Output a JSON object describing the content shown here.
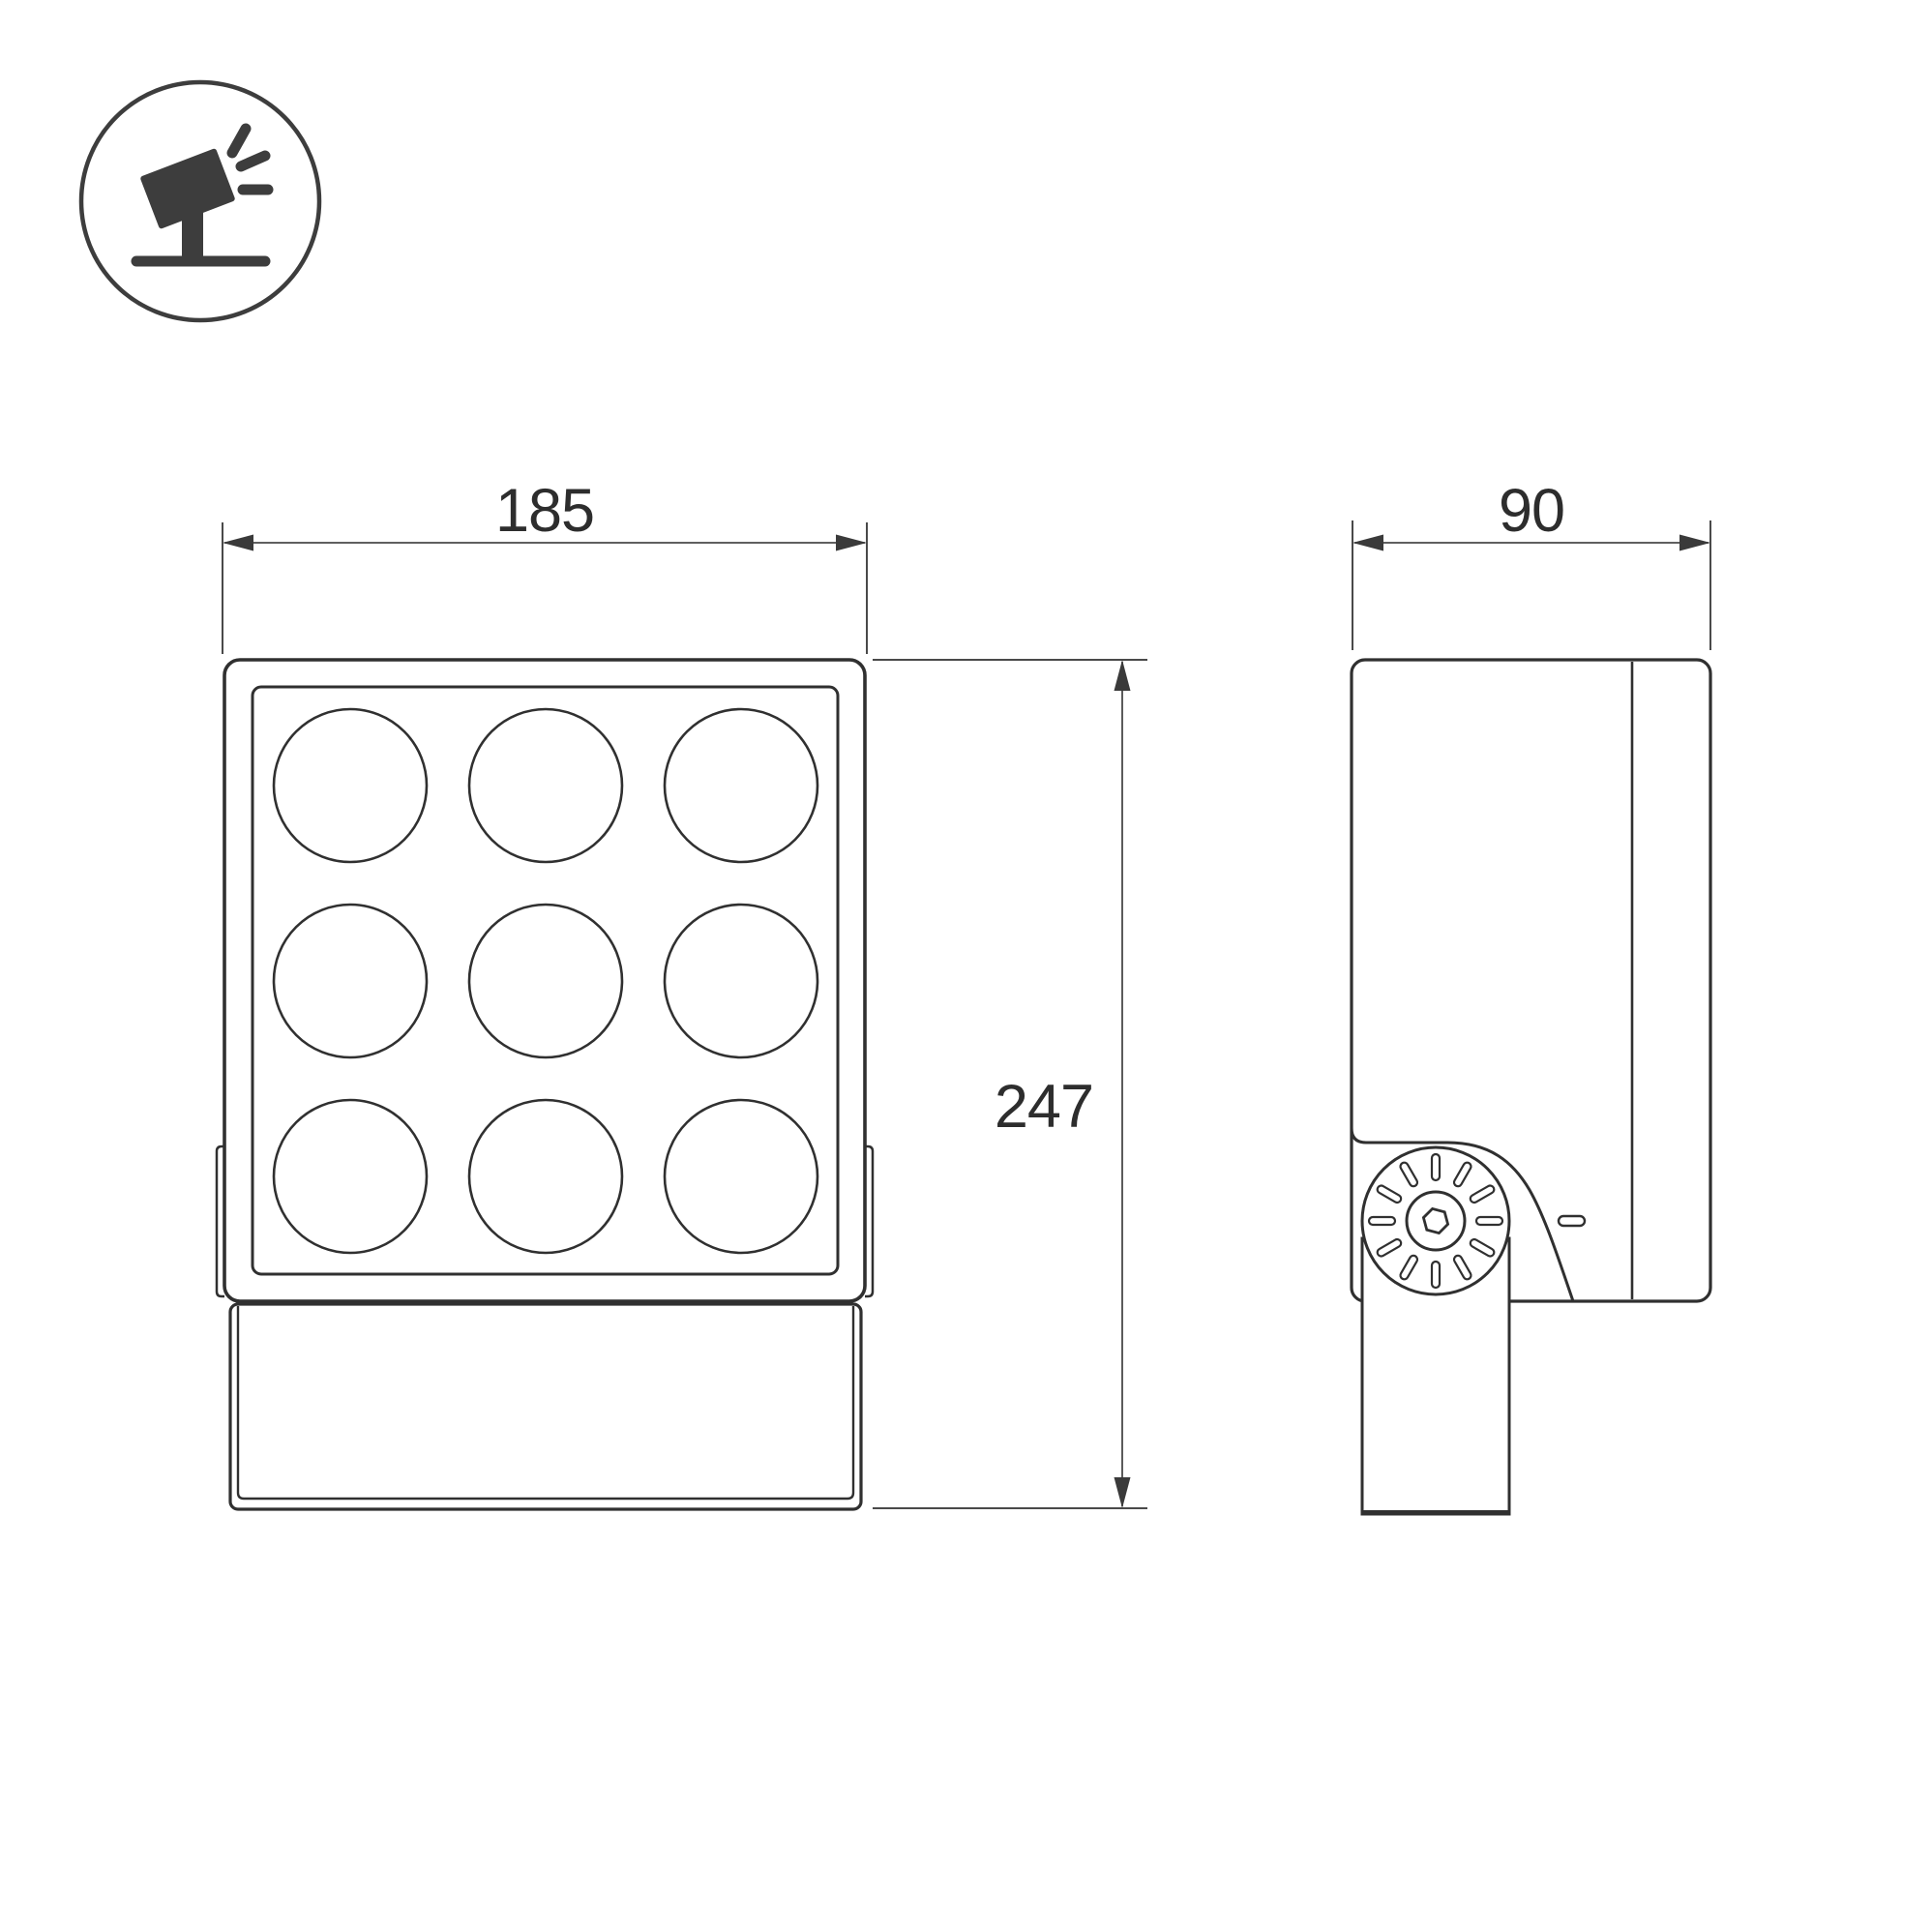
{
  "document": {
    "kind": "technical-dimension-drawing",
    "subject": "LED floodlight projector, front and side orthographic views"
  },
  "icon": {
    "name": "tilted-floodlight-on-stand",
    "color": "#3d3d3d"
  },
  "dimensions": {
    "front_width_mm": "185",
    "side_depth_mm": "90",
    "front_height_mm": "247"
  },
  "views": {
    "front": {
      "name": "front-view",
      "lens_rows": 3,
      "lens_cols": 3
    },
    "side": {
      "name": "side-view",
      "features": [
        "pivot-knob",
        "mounting-post",
        "back-plate-divider"
      ]
    }
  },
  "colors": {
    "outline": "#303030",
    "dimension_line": "#4a4a4a",
    "arrow_fill": "#3a3a3a",
    "text": "#2d2d2d",
    "background": "#ffffff"
  }
}
